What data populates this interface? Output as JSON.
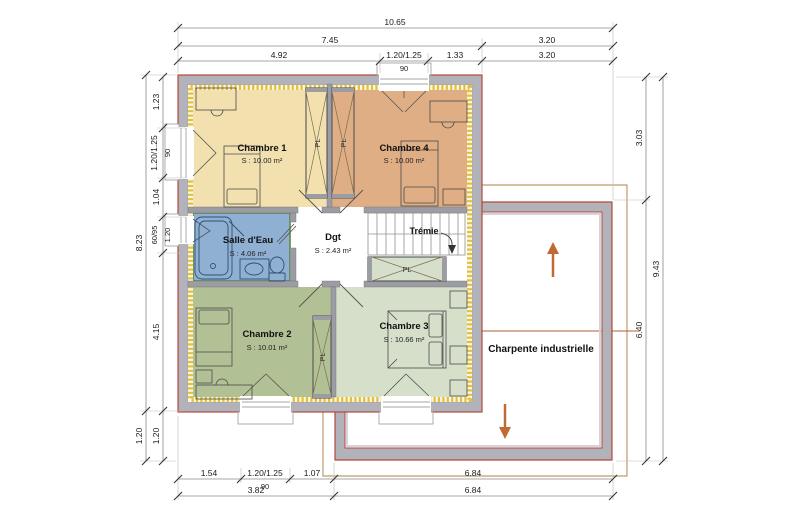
{
  "colors": {
    "wall_fill": "#b2b2ba",
    "wall_outline": "#b5483c",
    "partition_fill": "#9c9ca4",
    "insulation": "#e3bf3e",
    "insulation_bg": "#fdf8e2",
    "chambre1": "#f2e1af",
    "chambre4": "#dfae84",
    "salle_eau": "#90b0d3",
    "salle_eau_border": "#5a8c3f",
    "chambre2": "#b2c195",
    "chambre3": "#d5dfca",
    "closet": "#d5dfca",
    "dgt": "#ffffff",
    "roof_outline": "#c19a6b",
    "ridge_line": "#a9603a",
    "arrow": "#bf6a33",
    "dim_line": "#8a8a8a",
    "dim_text": "#1a1a1a"
  },
  "rooms": {
    "chambre1": {
      "name": "Chambre 1",
      "area": "S : 10.00 m²"
    },
    "chambre4": {
      "name": "Chambre 4",
      "area": "S : 10.00 m²"
    },
    "salle_eau": {
      "name": "Salle d'Eau",
      "area": "S : 4.06 m²"
    },
    "dgt": {
      "name": "Dgt",
      "area": "S : 2.43 m²"
    },
    "chambre2": {
      "name": "Chambre 2",
      "area": "S : 10.01 m²"
    },
    "chambre3": {
      "name": "Chambre 3",
      "area": "S : 10.66 m²"
    }
  },
  "annotations": {
    "tremie": "Trémie",
    "charpente": "Charpente industrielle",
    "closet": "PL"
  },
  "dimensions": {
    "top": {
      "total": "10.65",
      "row2": [
        "7.45",
        "3.20"
      ],
      "row3": [
        "4.92",
        "1.20/1.25",
        "1.33",
        "3.20"
      ],
      "sill": "90"
    },
    "left": {
      "outer": [
        "8.23",
        "1.20"
      ],
      "inner": [
        "1.23",
        "1.20/1.25",
        "1.04",
        "60/95",
        "4.15",
        "1.20"
      ],
      "sill": "90",
      "allege": "1.20"
    },
    "right": {
      "inner": [
        "3.03",
        "6.40"
      ],
      "outer": "9.43"
    },
    "bottom": {
      "row1": [
        "1.54",
        "1.20/1.25",
        "1.07",
        "6.84"
      ],
      "sill": "90",
      "row2": [
        "3.82",
        "6.84"
      ]
    }
  }
}
